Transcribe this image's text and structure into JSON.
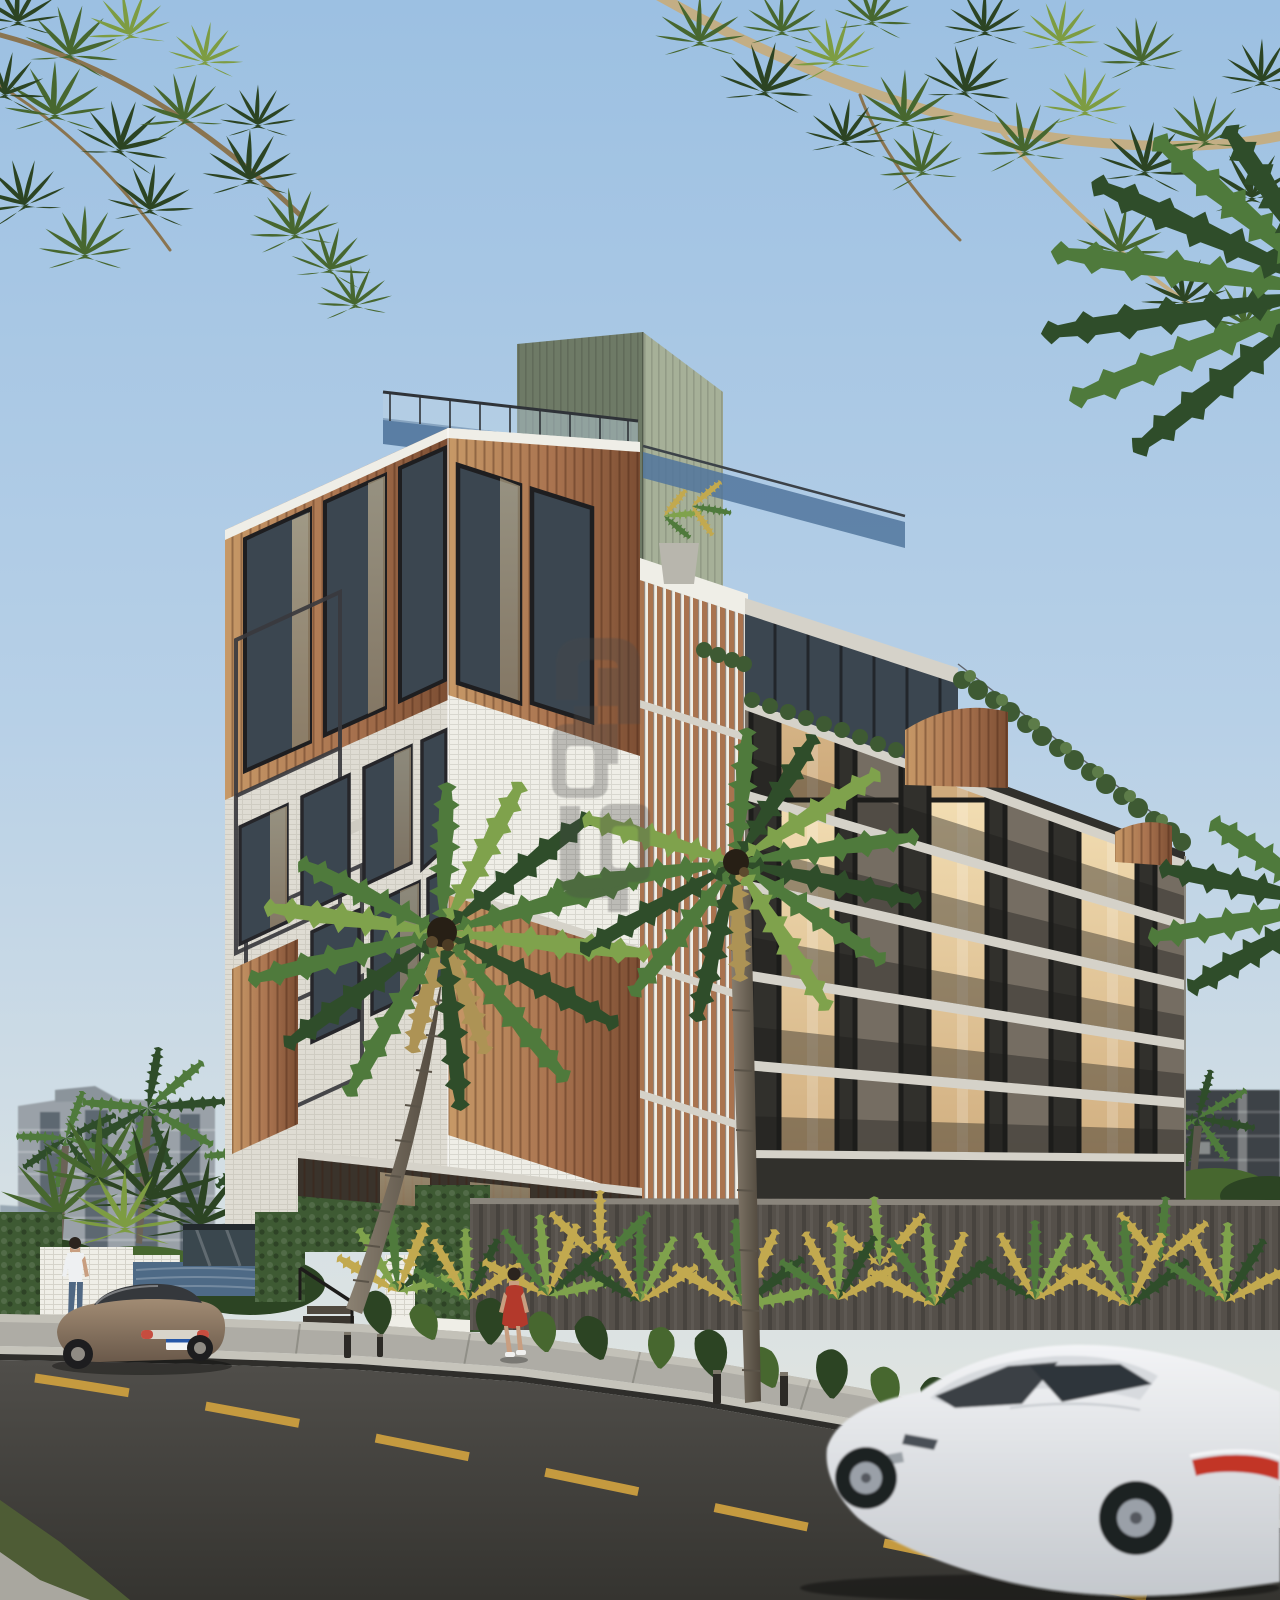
{
  "labels": {
    "scene": "Tropical residential apartment building exterior render at dusk",
    "sky": "Clear blue sky",
    "canopy": "Overhanging tree canopy framing the top",
    "background_city": "Background city towers",
    "building": "Mixed-material apartment building",
    "green_core": "Sage green rooftop service core",
    "roof_terrace": "Rooftop terrace with glass railing",
    "dark_wing": "Charcoal facade wing with balconies",
    "louver_screen": "Vertical wood louver screen",
    "corner_tower": "White tile corner tower with wood panels",
    "perimeter_wall": "Concrete perimeter wall",
    "garden": "Tropical street garden with uplighting",
    "palm_a": "Coconut palm in front of white facade",
    "palm_b": "Coconut palm at sidewalk edge",
    "street": "Asphalt street",
    "sidewalk": "Concrete sidewalk",
    "lane_markings": "Yellow dashed lane line",
    "sedan": "Bronze sedan parked at curb",
    "coupe": "White sports coupe driving past",
    "man": "Man walking in white t-shirt and jeans",
    "woman": "Woman walking in red dress",
    "stairs": "Entrance timber stairs with handrail",
    "pool_wall": "Blue tiled water-feature wall",
    "bollards": "Sidewalk light bollards",
    "watermark": "Translucent monogram watermark"
  },
  "colors": {
    "sky-top": "#9cc0e2",
    "sky-mid": "#b7d0e7",
    "sky-low": "#d8e1e4",
    "sky-horizon": "#e8e7dc",
    "leaf-dark": "#2c4423",
    "leaf-mid": "#47672f",
    "leaf-sun": "#7d9c42",
    "branch": "#8a7450",
    "branch-light": "#c3ae85",
    "palm-dark": "#2f4d2a",
    "palm-green": "#4f7a3c",
    "palm-light": "#7fa24c",
    "palm-gold": "#c2a94f",
    "palm-tan": "#ad9355",
    "trunk-light": "#8c8273",
    "trunk-dark": "#4e463b",
    "white-face": "#efeee7",
    "white-shade": "#dfdcd3",
    "wood-light": "#c79967",
    "wood-mid": "#a9734f",
    "wood-dark": "#7c4e33",
    "frame-dark": "#26262a",
    "glass-dark": "#3b4650",
    "glass-blue": "#51759c",
    "win-warm": "#e7d1a8",
    "win-dim": "#756d62",
    "green-front": "#6e7a66",
    "green-side": "#a6b098",
    "dark-facade": "#31302c",
    "slab": "#d5d2c9",
    "hedge": "#3e5a33",
    "hedge-light": "#5d7c49",
    "wall": "#55504a",
    "pool-tile": "#4e6a86",
    "glassbox": "#3a474e",
    "bg-tower": "#9aa1a8",
    "bg-glass": "#5d6871",
    "bg-dark": "#3e4347",
    "sidewalk": "#aeaca5",
    "sidewalk-light": "#c3c1b8",
    "curb": "#c6c4bb",
    "road": "#434240",
    "lane": "#c59a3f",
    "grass": "#4e5c35",
    "sedan": "#8b7765",
    "coupe": "#e5e7ea",
    "tail-red": "#c23527",
    "skin": "#c89e80",
    "dress-red": "#b3392b",
    "tee-white": "#eef0f2",
    "jeans": "#4f6783",
    "hair": "#2b241e",
    "wm": "#4a4a48"
  },
  "watermark": {
    "opacity": 0.3
  }
}
